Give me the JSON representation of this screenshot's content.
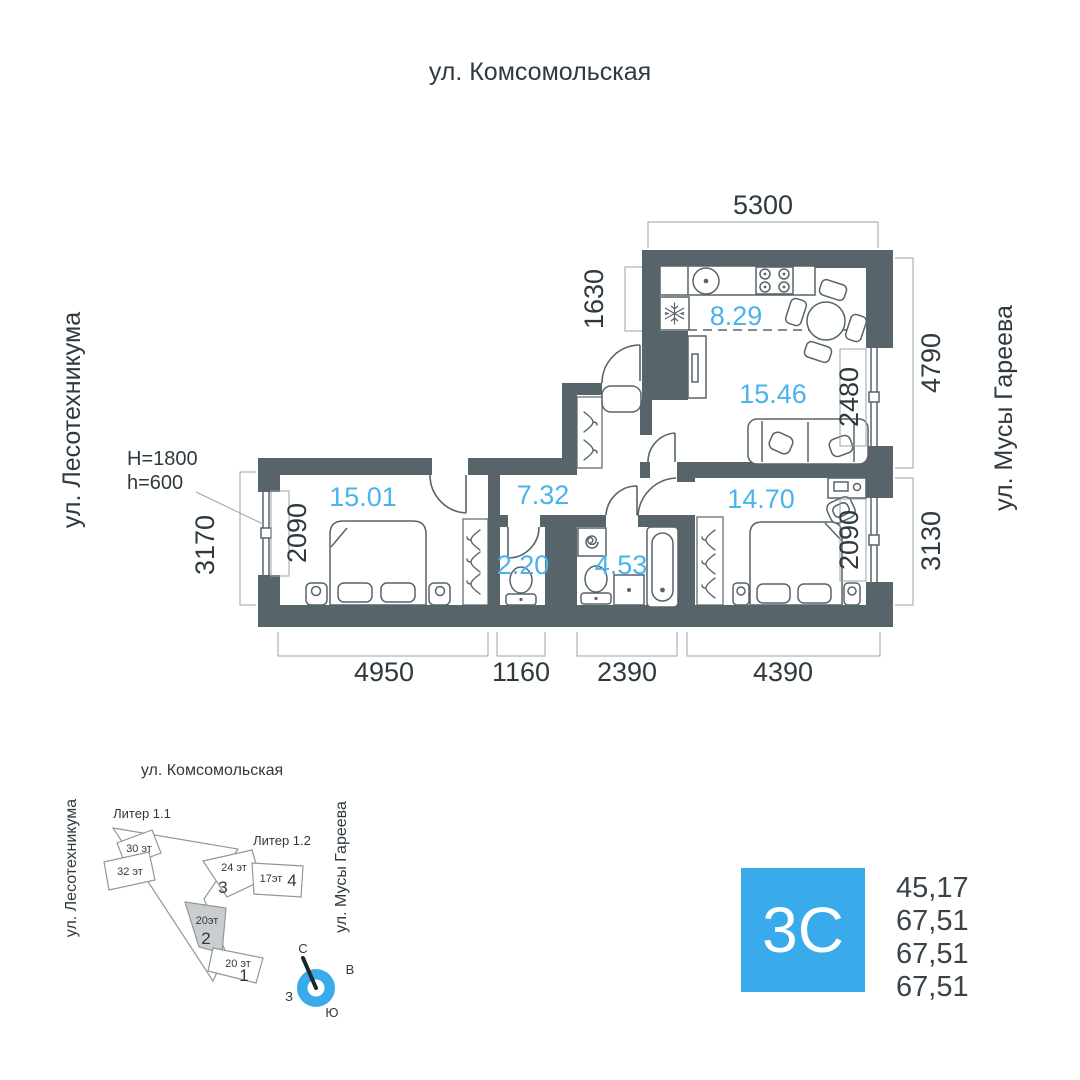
{
  "colors": {
    "accent_blue": "#4ab3ec",
    "badge_blue": "#3aabea",
    "wall": "#57646a",
    "dim_text": "#2e3a40",
    "highlight_fill": "#c9cdcd"
  },
  "streets": {
    "top": "ул. Комсомольская",
    "left": "ул. Лесотехникума",
    "right": "ул. Мусы Гареева"
  },
  "plan": {
    "rooms": {
      "kitchen": "8.29",
      "living": "15.46",
      "bedroom1": "15.01",
      "hall": "7.32",
      "wc": "2.20",
      "bathroom": "4.53",
      "bedroom2": "14.70"
    },
    "dimensions": {
      "top": "5300",
      "niche": "1630",
      "right_upper": "4790",
      "living_window": "2480",
      "left_outer": "3170",
      "bedroom1_window": "2090",
      "right_lower": "3130",
      "bedroom2_window": "2090",
      "bottom_bedroom1": "4950",
      "bottom_wc": "1160",
      "bottom_bathroom": "2390",
      "bottom_bedroom2": "4390"
    },
    "window_note": {
      "line1": "H=1800",
      "line2": "h=600"
    }
  },
  "minimap": {
    "street_top": "ул. Комсомольская",
    "street_left": "ул. Лесотехникума",
    "street_right": "ул. Мусы Гареева",
    "liter_1": "Литер 1.1",
    "liter_2": "Литер 1.2",
    "buildings": {
      "b30": {
        "floors": "30 эт"
      },
      "b32": {
        "floors": "32 эт"
      },
      "b3": {
        "floors": "24 эт",
        "number": "3"
      },
      "b4": {
        "floors": "17эт",
        "number": "4"
      },
      "b2": {
        "floors": "20эт",
        "number": "2"
      },
      "b1": {
        "floors": "20 эт",
        "number": "1"
      }
    },
    "compass": {
      "north": "С",
      "east": "В",
      "south": "Ю",
      "west": "З"
    }
  },
  "badge": {
    "type": "3С",
    "areas": [
      "45,17",
      "67,51",
      "67,51",
      "67,51"
    ]
  }
}
